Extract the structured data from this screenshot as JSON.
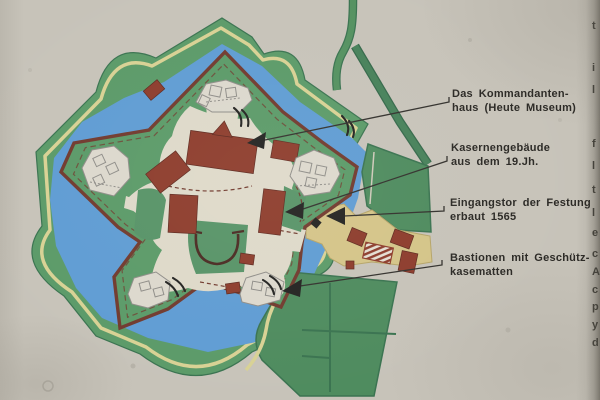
{
  "sign": {
    "type": "fortress plan (star fort) information board",
    "labels": [
      {
        "line1": "Das Kommandanten-",
        "line2": "haus (Heute Museum)"
      },
      {
        "line1": "Kasernengebäude",
        "line2": "aus dem 19.Jh."
      },
      {
        "line1": "Eingangstor der Festung",
        "line2": "erbaut 1565"
      },
      {
        "line1": "Bastionen mit Geschütz-",
        "line2": "kasematten"
      }
    ],
    "edge_fragments": [
      {
        "glyph": "t",
        "y": 20
      },
      {
        "glyph": "i",
        "y": 62
      },
      {
        "glyph": "l",
        "y": 84
      },
      {
        "glyph": "f",
        "y": 138
      },
      {
        "glyph": "l",
        "y": 160
      },
      {
        "glyph": "t",
        "y": 184
      },
      {
        "glyph": "l",
        "y": 207
      },
      {
        "glyph": "e",
        "y": 227
      },
      {
        "glyph": "c",
        "y": 248
      },
      {
        "glyph": "A",
        "y": 266
      },
      {
        "glyph": "c",
        "y": 284
      },
      {
        "glyph": "p",
        "y": 301
      },
      {
        "glyph": "y",
        "y": 319
      },
      {
        "glyph": "d",
        "y": 337
      }
    ]
  },
  "colors": {
    "concrete": "#c7c3b9",
    "glacis": "#5b9a68",
    "lawn": "#579367",
    "field": "#4e8b5e",
    "field_border": "#3a7350",
    "moat": "#5f9cd3",
    "yellow": "#d8d194",
    "maroon": "#713a2e",
    "red": "#8d3c2c",
    "cream": "#ded9c9",
    "tan": "#d4c488",
    "structure": "#dcd8cd",
    "structure_line": "#8f8d88",
    "ink": "#2b2925",
    "shadow": "#87837a"
  }
}
